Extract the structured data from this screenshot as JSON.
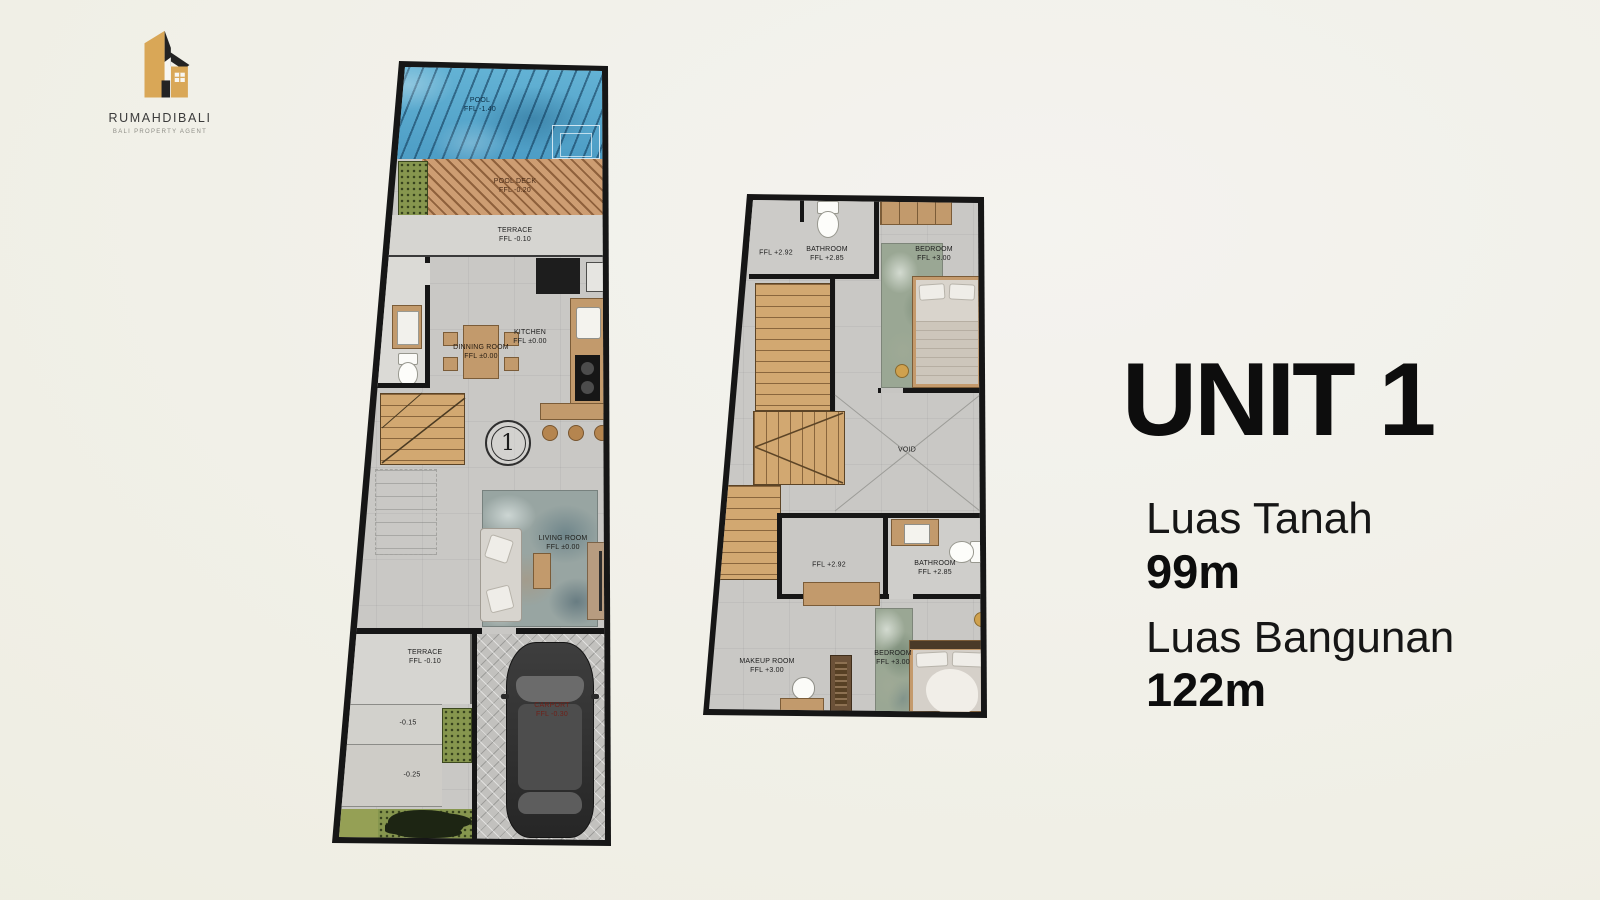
{
  "logo": {
    "brand": "RUMAHDIBALI",
    "tagline": "BALI PROPERTY AGENT",
    "icon": "house-logo-icon",
    "gold": "#d9a757",
    "dark": "#232323"
  },
  "info": {
    "title": "UNIT 1",
    "land_label": "Luas Tanah",
    "land_value": "99m",
    "building_label": "Luas Bangunan",
    "building_value": "122m"
  },
  "plan1": {
    "name": "ground-floor-plan",
    "marker": "1",
    "pool": {
      "label": "POOL",
      "ffl": "FFL  -1.40"
    },
    "pool_deck": {
      "label": "POOL DECK",
      "ffl": "FFL  -0.20"
    },
    "terrace_top": {
      "label": "TERRACE",
      "ffl": "FFL  -0.10"
    },
    "dinning": {
      "label": "DINNING ROOM",
      "ffl": "FFL  ±0.00"
    },
    "kitchen": {
      "label": "KITCHEN",
      "ffl": "FFL  ±0.00"
    },
    "living": {
      "label": "LIVING ROOM",
      "ffl": "FFL  ±0.00"
    },
    "terrace_bottom": {
      "label": "TERRACE",
      "ffl": "FFL  -0.10"
    },
    "step_1": "-0.15",
    "step_2": "-0.25",
    "carport": {
      "label": "CARPORT",
      "ffl": "FFL  -0.30"
    }
  },
  "plan2": {
    "name": "upper-floor-plan",
    "landing_top": "FFL  +2.92",
    "bathroom_top": {
      "label": "BATHROOM",
      "ffl": "FFL  +2.85"
    },
    "bedroom_top": {
      "label": "BEDROOM",
      "ffl": "FFL  +3.00"
    },
    "void": "VOID",
    "landing_mid": "FFL  +2.92",
    "bathroom_mid": {
      "label": "BATHROOM",
      "ffl": "FFL  +2.85"
    },
    "makeup": {
      "label": "MAKEUP ROOM",
      "ffl": "FFL  +3.00"
    },
    "bedroom_bottom": {
      "label": "BEDROOM",
      "ffl": "FFL  +3.00"
    }
  },
  "palette": {
    "background": "#f1f0ec",
    "wall": "#161616",
    "floor": "#c9c8c5",
    "pool_blue": "#57abce",
    "deck_brown": "#c29062",
    "wood": "#d2a871",
    "garden_green": "#86964e",
    "text": "#141414"
  }
}
